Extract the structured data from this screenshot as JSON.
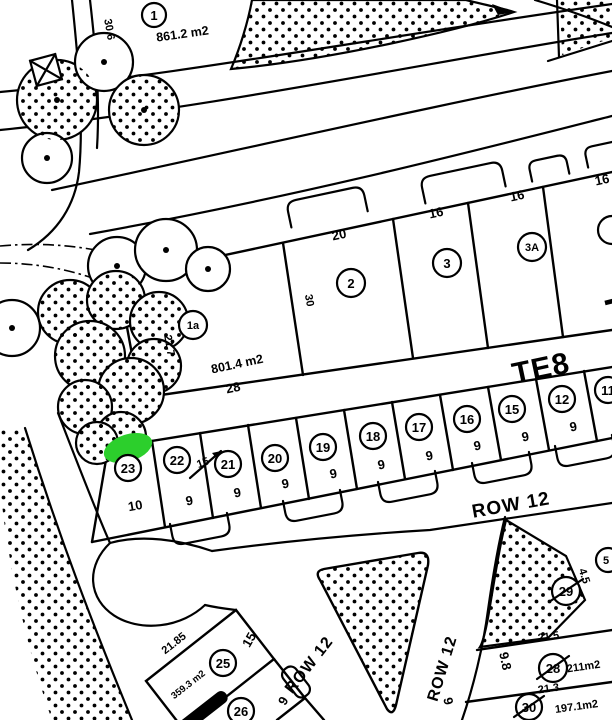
{
  "map": {
    "highlight_color": "#2ccf2c",
    "block_labels": {
      "te8": "TE8",
      "te8_partial": "T"
    },
    "road_labels": {
      "row12_main": "ROW 12",
      "row12_left": "ROW 12",
      "row12_right": "ROW 12"
    },
    "lot1": {
      "num": "1",
      "area": "861.2 m2",
      "dim_side": "30.6"
    },
    "lot1a": {
      "num": "1a",
      "area": "801.4 m2",
      "dim_bottom": "28",
      "dim_left": "21.7",
      "dim_right": "30"
    },
    "row_top": {
      "lots": [
        "2",
        "3",
        "3A"
      ],
      "dims": [
        "20",
        "16",
        "16",
        "16"
      ]
    },
    "row_mid": {
      "lots": [
        "23",
        "22",
        "21",
        "20",
        "19",
        "18",
        "17",
        "16",
        "15",
        "12",
        "11"
      ],
      "dims": [
        "10",
        "9",
        "9",
        "9",
        "9",
        "9",
        "9",
        "9",
        "9",
        "9"
      ],
      "strike_note": "15"
    },
    "lot25": {
      "num": "25",
      "area": "359.3 m2",
      "dim_nw": "21.85",
      "dim_ne": "15",
      "dim_se": "9"
    },
    "lot26": {
      "num": "26"
    },
    "lot29": {
      "num": "29",
      "dim": "4.5"
    },
    "lot28": {
      "num": "28",
      "area": "211m2",
      "dim_top": "21.5",
      "dim_left": "9.8"
    },
    "lot30": {
      "num": "30",
      "area": "197.1m2",
      "dim_top": "21.3",
      "dim_left": "9"
    },
    "lot_edge_partial": {
      "num": "5"
    }
  }
}
